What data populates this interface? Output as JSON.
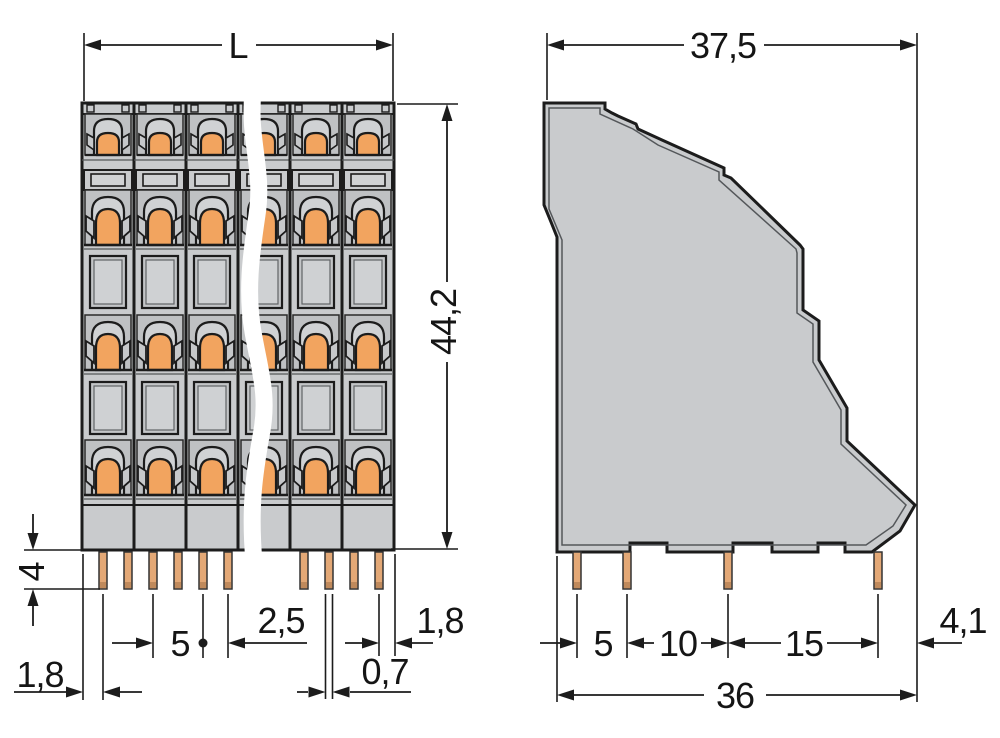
{
  "front_view": {
    "length_label": "L",
    "height_mm": "44,2",
    "pin_length_mm": "4",
    "edge_to_first_pin_mm": "1,8",
    "pole_pitch_mm": "5",
    "pin_row_offset_mm": "2,5",
    "pin_width_mm": "0,7",
    "last_pin_to_edge_mm": "1,8"
  },
  "side_view": {
    "depth_mm": "37,5",
    "pin_span_1_mm": "5",
    "pin_span_2_mm": "10",
    "pin_span_3_mm": "15",
    "edge_offset_mm": "4,1",
    "base_depth_mm": "36"
  },
  "colors": {
    "housing_gray": "#c9cbcd",
    "panel_gray": "#bfc1c3",
    "actuator_orange": "#f2a45f",
    "pin_copper": "#e3a876",
    "pin_tip": "#c08a5c",
    "line": "#1c1c1c"
  }
}
